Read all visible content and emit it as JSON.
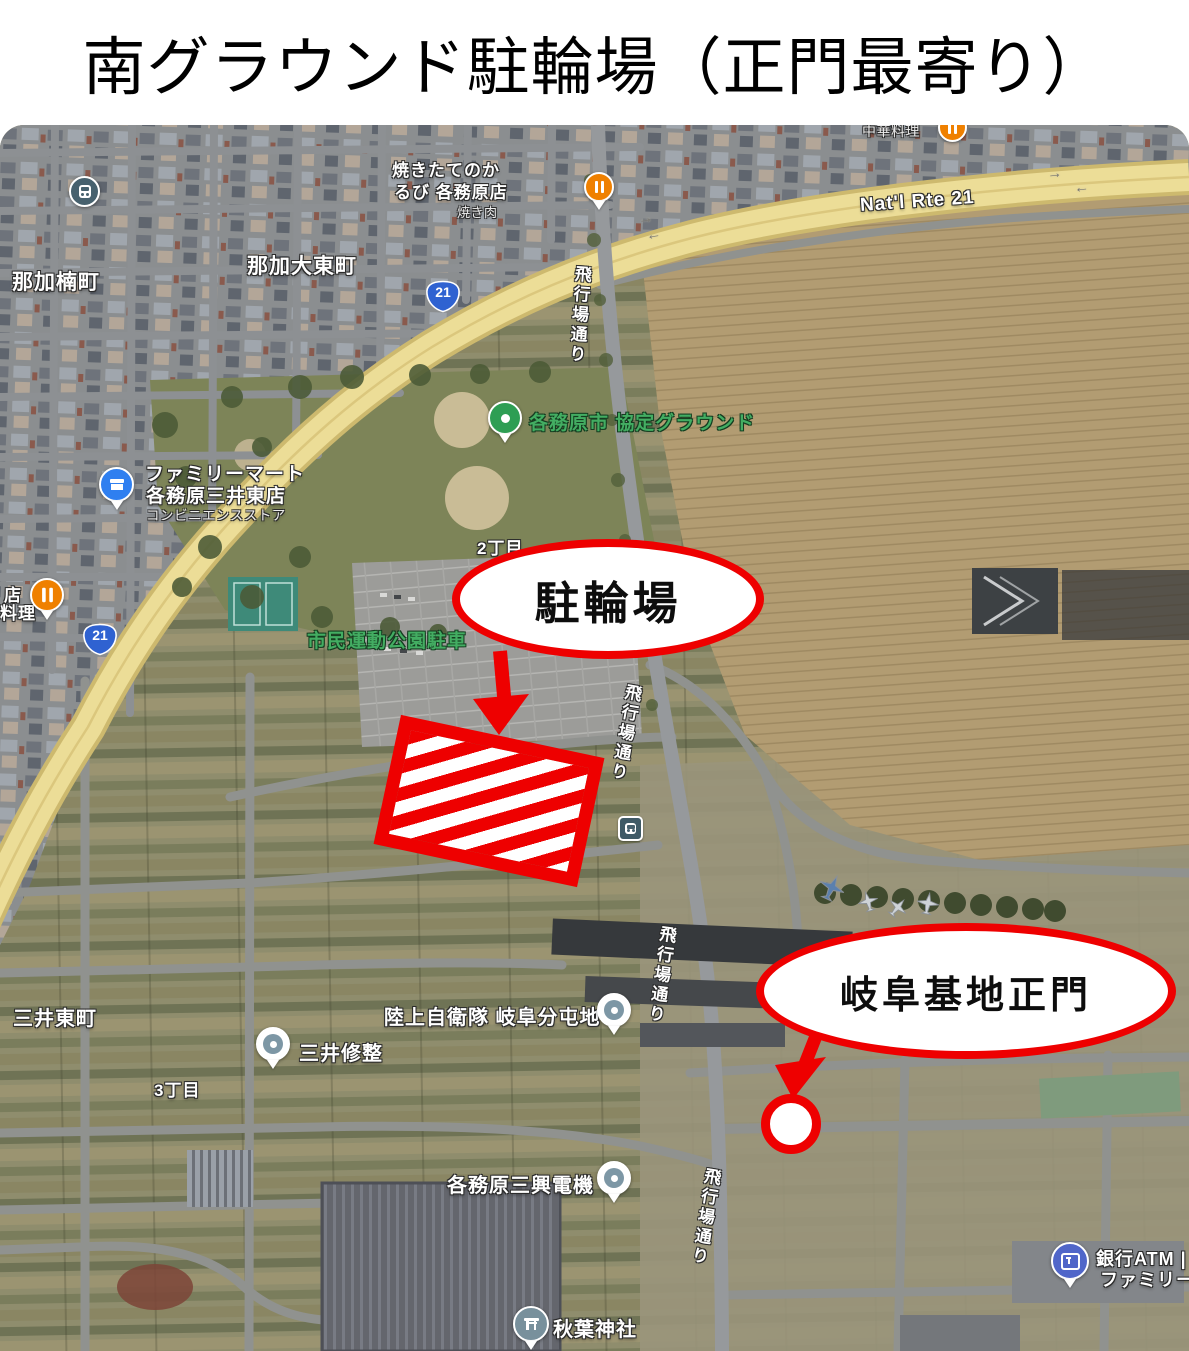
{
  "page": {
    "title": "南グラウンド駐輪場（正門最寄り）"
  },
  "annotations": {
    "bike_parking": "駐輪場",
    "gate": "岐阜基地正門",
    "annotation_red": "#ee0000"
  },
  "roads": {
    "natl_rte_21": "Nat'l Rte 21",
    "route_21": "21",
    "hikojo_dori": "飛行場通り",
    "arrow_right": "→",
    "arrow_left": "←"
  },
  "places": {
    "naka_kusunoki": "那加楠町",
    "naka_daito": "那加大東町",
    "yakitate_1": "焼きたてのか",
    "yakitate_2": "るび 各務原店",
    "yakiniku": "焼き肉",
    "chuka_ryori": "中華料理",
    "kyotei_ground": "各務原市 協定グラウンド",
    "familymart_1": "ファミリーマート",
    "familymart_2": "各務原三井東店",
    "familymart_3": "コンビニエンスストア",
    "mise": "店",
    "ryori": "料理",
    "ni_chome": "2丁目",
    "shimin_parking": "市民運動公園駐車",
    "mitsui_higashi": "三井東町",
    "mitsui_shusei": "三井修整",
    "san_chome": "3丁目",
    "rikujo_jieitai": "陸上自衛隊 岐阜分屯地",
    "sanko_denki": "各務原三興電機",
    "akiba_jinja": "秋葉神社",
    "ginko_atm": "銀行ATM |",
    "family_partial": "ファミリー"
  }
}
